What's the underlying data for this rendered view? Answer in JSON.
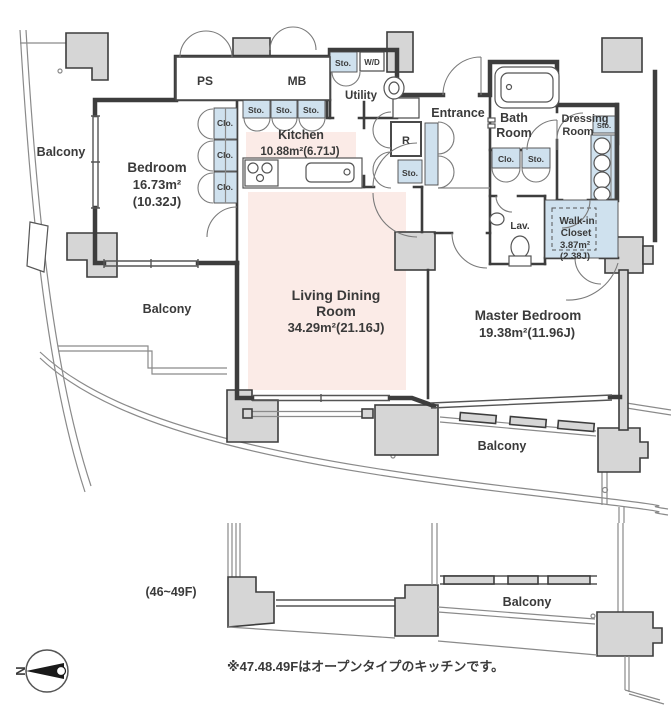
{
  "plan": {
    "note": "※47.48.49Fはオープンタイプのキッチンです。",
    "floor_label": "(46~49F)",
    "compass_letter": "N"
  },
  "labels": {
    "balcony": "Balcony",
    "sto": "Sto.",
    "clo": "Clo.",
    "ps": "PS",
    "mb": "MB",
    "wd": "W/D",
    "r": "R",
    "utility": "Utility",
    "entrance": "Entrance",
    "lav": "Lav."
  },
  "rooms": {
    "bedroom": {
      "name": "Bedroom",
      "area": "16.73m²",
      "tatami": "(10.32J)"
    },
    "kitchen": {
      "name": "Kitchen",
      "area": "10.88m²(6.71J)"
    },
    "living": {
      "name_line1": "Living Dining",
      "name_line2": "Room",
      "area": "34.29m²(21.16J)"
    },
    "master": {
      "name": "Master Bedroom",
      "area": "19.38m²(11.96J)"
    },
    "bath": {
      "name_line1": "Bath",
      "name_line2": "Room"
    },
    "dressing": {
      "name_line1": "Dressing",
      "name_line2": "Room"
    },
    "walkin": {
      "name_line1": "Walk-in",
      "name_line2": "Closet",
      "area": "3.87m²",
      "tatami": "(2.38J)"
    }
  },
  "colors": {
    "accent_pink": "#fbebe7",
    "accent_blue": "#cfe1ee",
    "wall": "#3d3d3d",
    "pillar": "#d6d6d6"
  }
}
